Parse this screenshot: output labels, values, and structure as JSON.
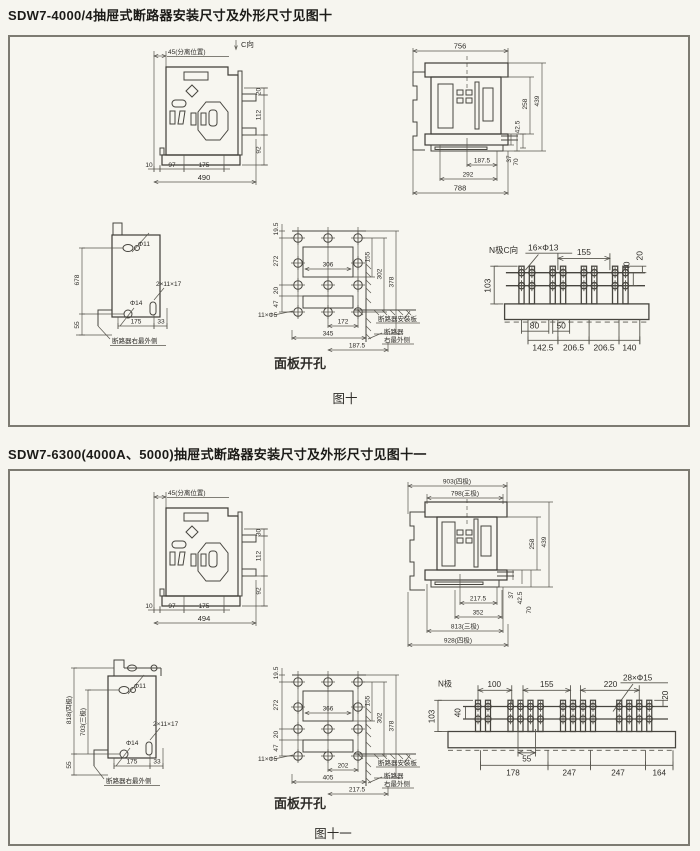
{
  "page": {
    "title1": "SDW7-4000/4抽屉式断路器安装尺寸及外形尺寸见图十",
    "title2": "SDW7-6300(4000A、5000)抽屉式断路器安装尺寸及外形尺寸见图十一"
  },
  "fig10": {
    "caption": "图十",
    "panel_caption": "面板开孔",
    "side": {
      "view_dir": "C向",
      "separated": "45(分离位置)",
      "right": [
        "20",
        "112",
        "92"
      ],
      "bottom": [
        "10",
        "97",
        "175"
      ],
      "overall": "490"
    },
    "front": {
      "top": "756",
      "right": [
        "258",
        "439",
        "42.5",
        "37",
        "70"
      ],
      "bottom": [
        "187.5",
        "292",
        "788"
      ]
    },
    "mount": {
      "hole_top": "Φ11",
      "hole_mid": "Φ14",
      "slot": "2×11×17",
      "left": [
        "678",
        "55"
      ],
      "bottom": [
        "175",
        "33"
      ],
      "note": "断路器右最外侧"
    },
    "panel": {
      "left": [
        "19.5",
        "272",
        "20",
        "47"
      ],
      "inner": "306",
      "right": [
        "155",
        "302",
        "378"
      ],
      "holes": "11×Φ5",
      "bottom": [
        "172",
        "345",
        "187.5"
      ],
      "note_plate": "断路器安装板",
      "note_edge1": "断路器",
      "note_edge2": "右最外侧"
    },
    "busbar": {
      "label": "N极C向",
      "holes": "16×Φ13",
      "top": "155",
      "right": [
        "40",
        "20"
      ],
      "left": "103",
      "mid": [
        "80",
        "50"
      ],
      "bottom": [
        "142.5",
        "206.5",
        "206.5",
        "140"
      ]
    }
  },
  "fig11": {
    "caption": "图十一",
    "panel_caption": "面板开孔",
    "side": {
      "separated": "45(分离位置)",
      "right": [
        "30",
        "112",
        "92"
      ],
      "bottom": [
        "10",
        "97",
        "175"
      ],
      "overall": "494"
    },
    "front": {
      "top": [
        "903(四极)",
        "798(三极)"
      ],
      "right": [
        "258",
        "439",
        "37",
        "42.5",
        "70"
      ],
      "bottom": [
        "217.5",
        "352",
        "813(三极)",
        "928(四极)"
      ]
    },
    "mount": {
      "hole_top": "Φ11",
      "hole_mid": "Φ14",
      "slot": "2×11×17",
      "left": [
        "818(四极)",
        "703(三极)",
        "55"
      ],
      "bottom": [
        "175",
        "33"
      ],
      "note": "断路器右最外侧"
    },
    "panel": {
      "left": [
        "19.5",
        "272",
        "20",
        "47"
      ],
      "inner": "366",
      "right": [
        "155",
        "302",
        "378"
      ],
      "holes": "11×Φ5",
      "bottom": [
        "202",
        "405",
        "217.5"
      ],
      "note_plate": "断路器安装板",
      "note_edge1": "断路器",
      "note_edge2": "右最外侧"
    },
    "busbar": {
      "label": "N极",
      "holes": "28×Φ15",
      "top": [
        "100",
        "155",
        "220"
      ],
      "right": "20",
      "left": [
        "103",
        "40"
      ],
      "mid": "55",
      "bottom": [
        "178",
        "247",
        "247",
        "164"
      ]
    }
  }
}
